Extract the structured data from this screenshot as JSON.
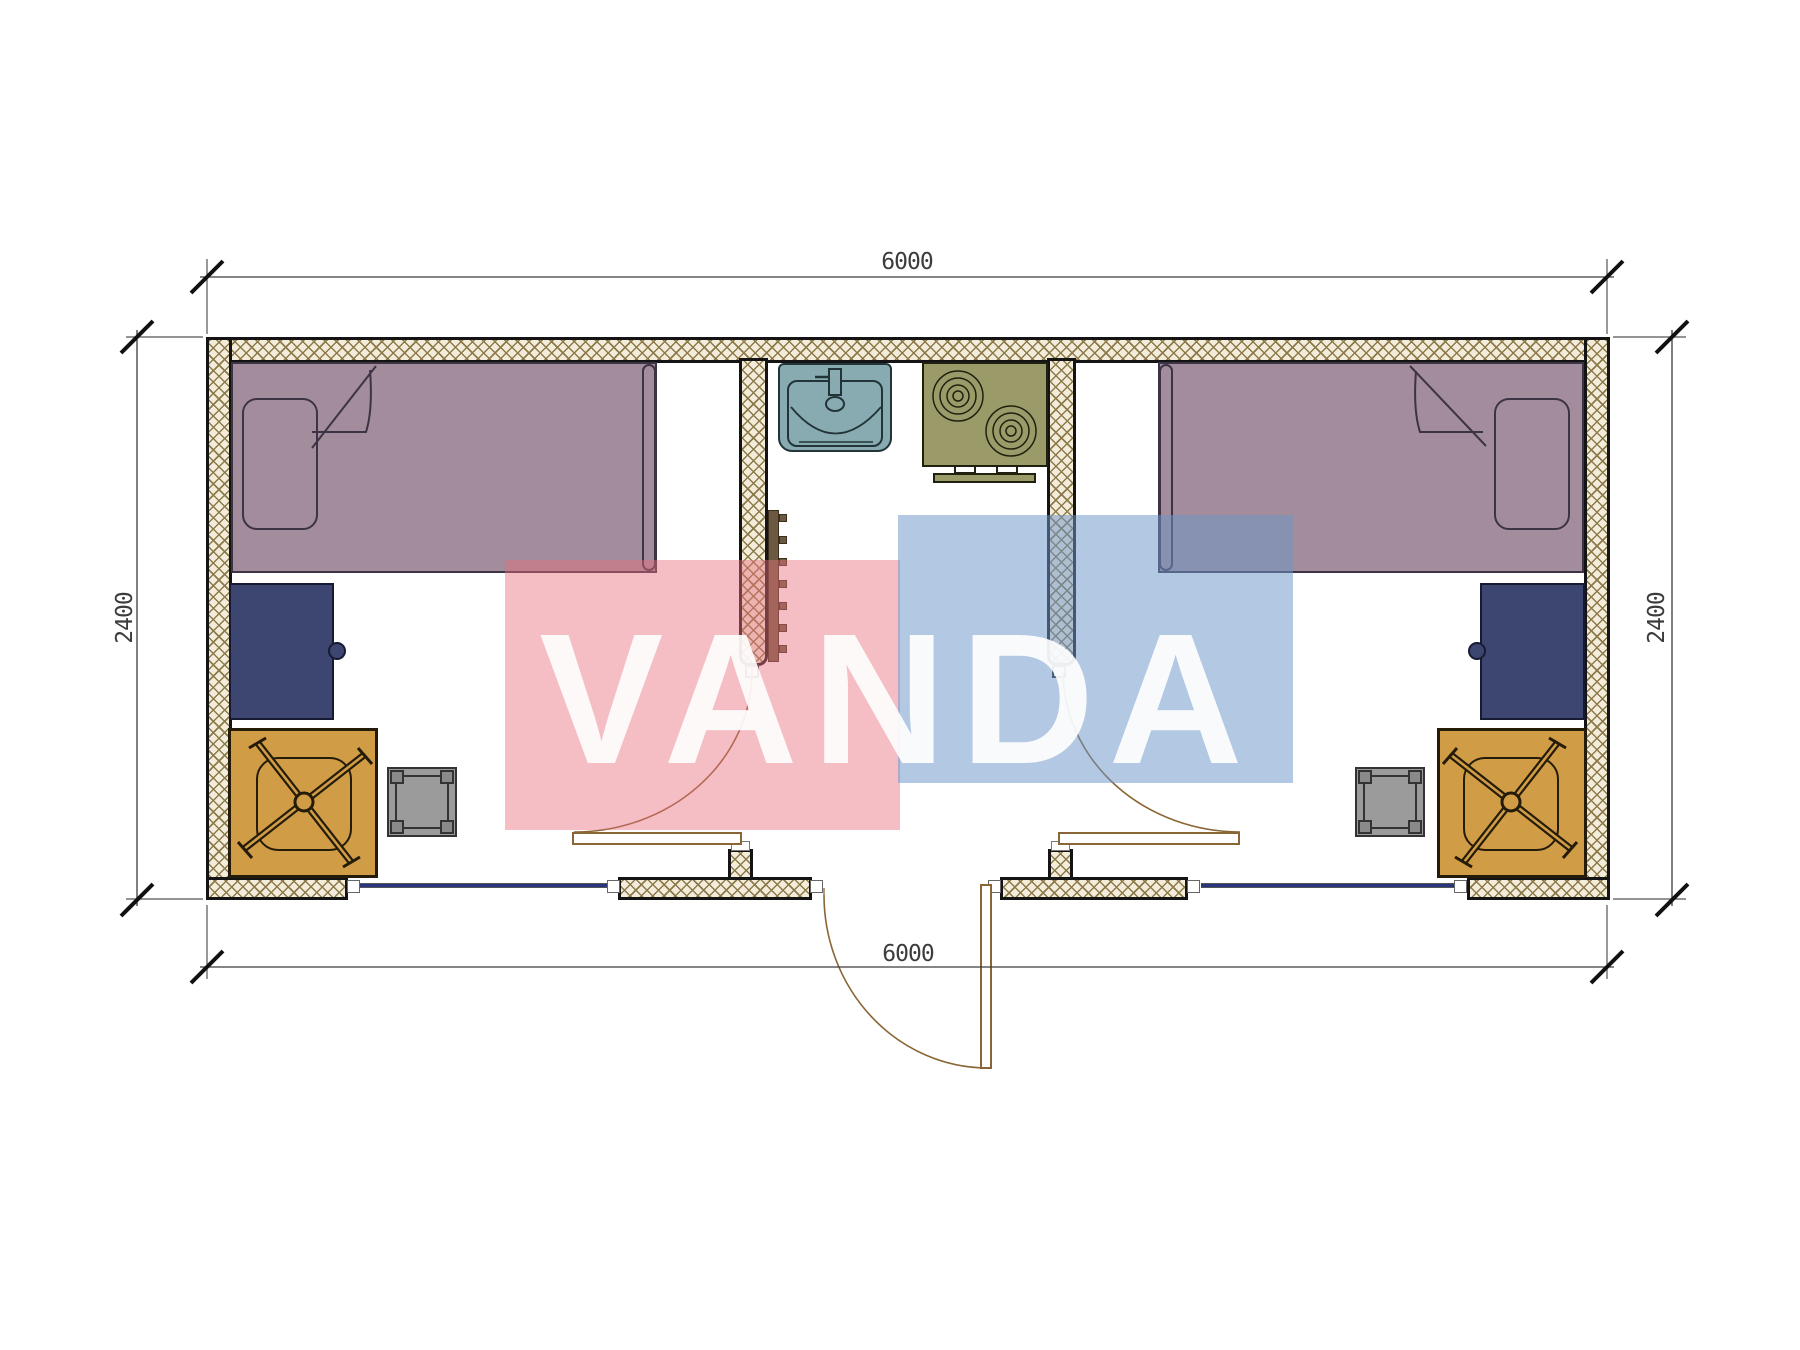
{
  "watermark": {
    "text": "VANDA"
  },
  "dimensions": {
    "top": "6000",
    "bottom": "6000",
    "left": "2400",
    "right": "2400"
  },
  "colors": {
    "wall_hatch_line": "#8d7a4a",
    "wall_fill": "#f3ecda",
    "wall_border": "#141414",
    "bed": "#a38c9c",
    "bed_border": "#3c3444",
    "desk": "#3d4670",
    "desk_border": "#161b33",
    "chair": "#d09c45",
    "chair_border": "#241b09",
    "stool": "#9b9b9b",
    "stool_border": "#333333",
    "sink": "#87abb1",
    "sink_border": "#223438",
    "stove": "#9b9b6a",
    "stove_border": "#20200f",
    "radiator": "#6d5941",
    "window": "#2a357f",
    "door": "#8a6535",
    "dim": "#3c3c3c",
    "watermark_pink": "rgba(230,110,125,0.45)",
    "watermark_blue": "rgba(110,150,200,0.52)",
    "watermark_text": "rgba(255,255,255,0.9)"
  }
}
